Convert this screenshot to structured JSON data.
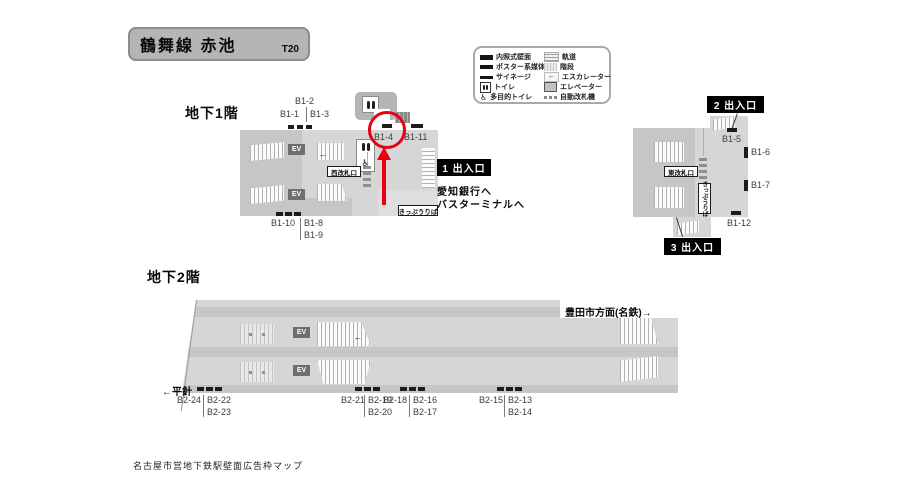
{
  "header": {
    "title": "鶴舞線 赤池",
    "code": "T20"
  },
  "legend": {
    "left": [
      {
        "icon": "lit-wall-panel",
        "label": "内照式壁面"
      },
      {
        "icon": "poster-media",
        "label": "ポスター系媒体"
      },
      {
        "icon": "signage",
        "label": "サイネージ"
      },
      {
        "icon": "toilet",
        "label": "トイレ"
      },
      {
        "icon": "accessible-toilet",
        "label": "多目的トイレ"
      }
    ],
    "right": [
      {
        "icon": "track",
        "label": "軌道"
      },
      {
        "icon": "stairs",
        "label": "階段"
      },
      {
        "icon": "escalator",
        "label": "エスカレーター"
      },
      {
        "icon": "elevator",
        "label": "エレベーター"
      },
      {
        "icon": "ticket-gate",
        "label": "自動改札機"
      }
    ]
  },
  "floor_b1": {
    "heading": "地下1階",
    "labels": {
      "b1_1": "B1-1",
      "b1_2": "B1-2",
      "b1_3": "B1-3",
      "b1_4": "B1-4",
      "b1_5": "B1-5",
      "b1_6": "B1-6",
      "b1_7": "B1-7",
      "b1_8": "B1-8",
      "b1_9": "B1-9",
      "b1_10": "B1-10",
      "b1_11": "B1-11",
      "b1_12": "B1-12"
    },
    "west_gate": "西改札口",
    "east_gate": "東改札口",
    "ticket_west": "きっぷうりば",
    "ticket_east": "きっぷうりば",
    "exit_1": "1 出入口",
    "exit_2": "2 出入口",
    "exit_3": "3 出入口",
    "exit_1_dest_1": "愛知銀行へ",
    "exit_1_dest_2": "バスターミナルへ"
  },
  "floor_b2": {
    "heading": "地下2階",
    "direction_right": "豊田市方面(名鉄)→",
    "direction_left": "←平針",
    "labels": {
      "b2_13": "B2-13",
      "b2_14": "B2-14",
      "b2_15": "B2-15",
      "b2_16": "B2-16",
      "b2_17": "B2-17",
      "b2_18": "B2-18",
      "b2_19": "B2-19",
      "b2_20": "B2-20",
      "b2_21": "B2-21",
      "b2_22": "B2-22",
      "b2_23": "B2-23",
      "b2_24": "B2-24"
    }
  },
  "icons": {
    "elevator_text": "EV",
    "wheelchair": "♿",
    "arrow_left": "←"
  },
  "footer": "名古屋市営地下鉄駅壁面広告枠マップ",
  "colors": {
    "annotation_red": "#e60012",
    "map_light": "#d6d6d6",
    "map_dark": "#c6c6c6",
    "exit_box_black": "#000000",
    "title_badge_gray": "#b5b5b5"
  }
}
